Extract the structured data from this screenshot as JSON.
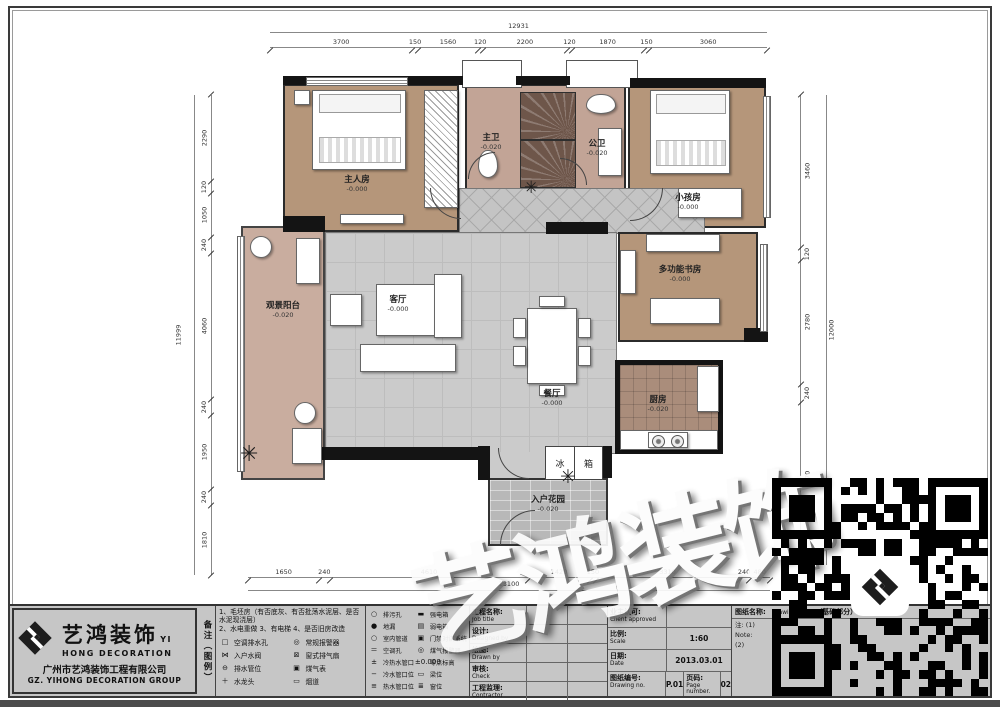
{
  "dimensions": {
    "top": {
      "total": "12931",
      "segments": [
        "3700",
        "150",
        "1560",
        "120",
        "2200",
        "120",
        "1870",
        "150",
        "3060"
      ]
    },
    "left": {
      "total": "11999",
      "segments": [
        "2290",
        "120",
        "1050",
        "240",
        "4060",
        "240",
        "1950",
        "240",
        "1810"
      ]
    },
    "right": {
      "total": "12000",
      "segments": [
        "3460",
        "120",
        "2780",
        "240",
        "3470"
      ]
    },
    "bottom": {
      "total": "13100",
      "segments": [
        "1650",
        "240",
        "4610",
        "1420",
        "150",
        "3310",
        "240",
        "480"
      ]
    }
  },
  "rooms": {
    "master": {
      "name": "主人房",
      "level": "-0.000"
    },
    "master_bath": {
      "name": "主卫",
      "level": "-0.020"
    },
    "public_bath": {
      "name": "公卫",
      "level": "-0.020"
    },
    "kids": {
      "name": "小孩房",
      "level": "-0.000"
    },
    "study": {
      "name": "多功能书房",
      "level": "-0.000"
    },
    "balcony": {
      "name": "观景阳台",
      "level": "-0.020"
    },
    "living": {
      "name": "客厅",
      "level": "-0.000"
    },
    "dining": {
      "name": "餐厅",
      "level": "-0.000"
    },
    "kitchen": {
      "name": "厨房",
      "level": "-0.020"
    },
    "foyer": {
      "name": "入户花园",
      "level": "-0.020"
    },
    "fridge": {
      "char1": "冰",
      "char2": "箱"
    }
  },
  "watermark": "艺鸿装饰",
  "plants": {
    "glyph": "✳"
  },
  "titleblock": {
    "company": {
      "name_cn": "艺鸿装饰",
      "name_en": "YI HONG DECORATION",
      "full_cn": "广州市艺鸿装饰工程有限公司",
      "full_en": "GZ. YIHONG DECORATION GROUP"
    },
    "notes_header": "备注（图例）",
    "notes": [
      "1、毛坯房（有否底灰、有否批荡水泥层、是否水泥现浇层）",
      "2、水电重做  3、有电梯  4、是否旧房改造"
    ],
    "legend_a": [
      {
        "sym": "□",
        "label": "空调排水孔"
      },
      {
        "sym": "⋈",
        "label": "入户水阀"
      },
      {
        "sym": "⊖",
        "label": "排水管位"
      },
      {
        "sym": "＋",
        "label": "水龙头"
      }
    ],
    "legend_b": [
      {
        "sym": "◎",
        "label": "常规报警器"
      },
      {
        "sym": "⊠",
        "label": "窗式排气扇"
      },
      {
        "sym": "▣",
        "label": "煤气表"
      },
      {
        "sym": "▭",
        "label": "烟道"
      }
    ],
    "legend_c": [
      {
        "sym": "○",
        "label": "排污孔"
      },
      {
        "sym": "●",
        "label": "地漏"
      },
      {
        "sym": "○",
        "label": "室内管道"
      },
      {
        "sym": "＝",
        "label": "空调孔"
      },
      {
        "sym": "±",
        "label": "冷热水管口"
      },
      {
        "sym": "−",
        "label": "冷水管口位"
      },
      {
        "sym": "≡",
        "label": "热水管口位"
      }
    ],
    "legend_d": [
      {
        "sym": "▬",
        "label": "强电箱"
      },
      {
        "sym": "▤",
        "label": "弱电箱"
      },
      {
        "sym": "▣",
        "label": "门禁对讲系统"
      },
      {
        "sym": "◎",
        "label": "煤气报警器"
      },
      {
        "sym": "±0.000",
        "label": "零点标高"
      },
      {
        "sym": "▭",
        "label": "梁位"
      },
      {
        "sym": "≣",
        "label": "窗位"
      }
    ],
    "project_rows": [
      {
        "cn": "工程名称:",
        "en": "Job title"
      },
      {
        "cn": "设计:",
        "en": "Designed by"
      },
      {
        "cn": "绘图:",
        "en": "Drawn by"
      },
      {
        "cn": "审核:",
        "en": "Check"
      },
      {
        "cn": "工程监理:",
        "en": "Contractor"
      }
    ],
    "approval": {
      "client_cn": "业主认可:",
      "client_en": "Client approved",
      "scale_cn": "比例:",
      "scale_en": "Scale",
      "scale_val": "1:60",
      "date_cn": "日期:",
      "date_en": "Date",
      "date_val": "2013.03.01",
      "dwgno_cn": "图纸编号:",
      "dwgno_en": "Drawing no.",
      "dwgno_val": "P.01",
      "page_cn": "页码:",
      "page_en": "Page number.",
      "page_val": "02"
    },
    "right_panel": {
      "title_cn": "图纸名称:",
      "title_en": "Drawing title",
      "subtitle": "（基础部分）",
      "note1_cn": "注: (1)",
      "note2_cn": "(2)",
      "note_en": "Note:"
    }
  }
}
